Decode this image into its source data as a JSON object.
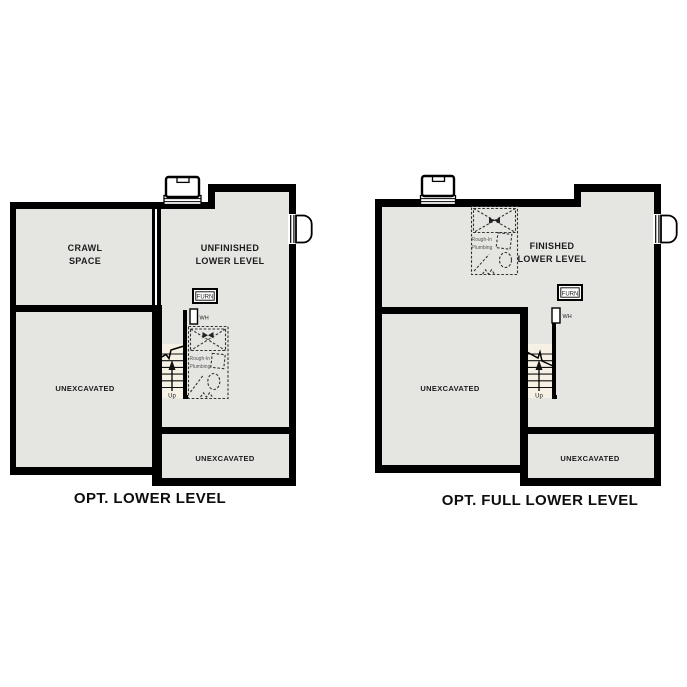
{
  "figure": {
    "type": "architectural-lower-level-options",
    "background": "#ffffff"
  },
  "colors": {
    "wall": "#000000",
    "floor": "#e5e5e2",
    "stair": "#f6f1e4",
    "label": "#1c1c1c",
    "dash": "#333333"
  },
  "plans": {
    "left": {
      "caption": "OPT. LOWER LEVEL",
      "rooms": {
        "crawl_line1": "CRAWL",
        "crawl_line2": "SPACE",
        "main_line1": "UNFINISHED",
        "main_line2": "LOWER LEVEL",
        "unexcavated_side": "UNEXCAVATED",
        "unexcavated_bottom": "UNEXCAVATED"
      },
      "labels": {
        "furnace": "FURN",
        "water_heater": "WH",
        "stair_direction": "Up",
        "plumbing_line1": "Rough-In",
        "plumbing_line2": "Plumbing"
      }
    },
    "right": {
      "caption": "OPT. FULL LOWER LEVEL",
      "rooms": {
        "main_line1": "FINISHED",
        "main_line2": "LOWER LEVEL",
        "unexcavated_side": "UNEXCAVATED",
        "unexcavated_bottom": "UNEXCAVATED"
      },
      "labels": {
        "furnace": "FURN",
        "water_heater": "WH",
        "stair_direction": "Up",
        "plumbing_line1": "Rough-In",
        "plumbing_line2": "Plumbing"
      }
    }
  }
}
